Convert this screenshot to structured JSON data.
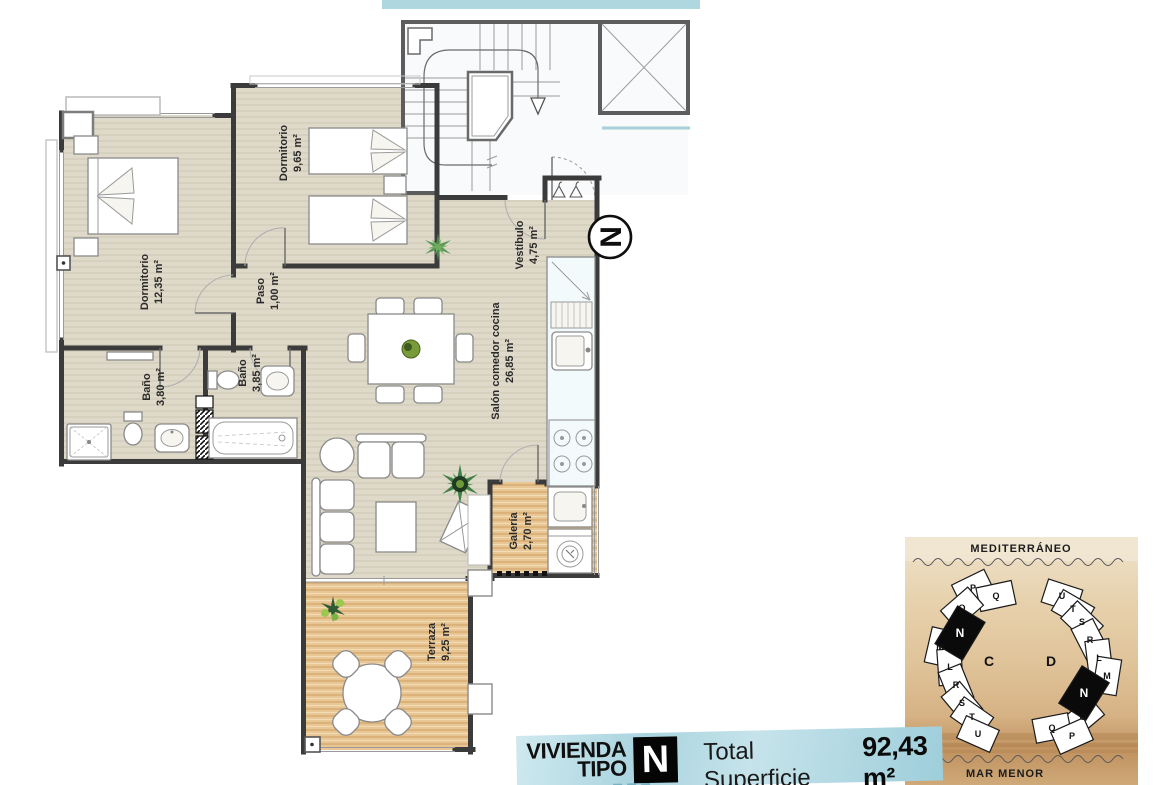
{
  "rooms": {
    "dormitorio1": {
      "name": "Dormitorio",
      "area": "12,35 m²"
    },
    "dormitorio2": {
      "name": "Dormitorio",
      "area": "9,65 m²"
    },
    "paso": {
      "name": "Paso",
      "area": "1,00 m²"
    },
    "bano1": {
      "name": "Baño",
      "area": "3,80 m²"
    },
    "bano2": {
      "name": "Baño",
      "area": "3,85 m²"
    },
    "salon": {
      "name": "Salón comedor cocina",
      "area": "26,85 m²"
    },
    "vestibulo": {
      "name": "Vestíbulo",
      "area": "4,75 m²"
    },
    "galeria": {
      "name": "Galería",
      "area": "2,70 m²"
    },
    "terraza": {
      "name": "Terraza",
      "area": "9,25 m²"
    }
  },
  "compass": {
    "letter": "N"
  },
  "title_block": {
    "line1": "VIVIENDA",
    "line2": "TIPO",
    "type_letter": "N",
    "total_label": "Total Superficie",
    "total_value": "92,43 m²",
    "footnote": "* Incluyendo zonas comunes, terrazas y galería al 100%"
  },
  "site_map": {
    "top_label": "MEDITERRÁNEO",
    "bottom_label": "MAR MENOR",
    "buildings": [
      {
        "name": "C",
        "units": [
          "P",
          "Q",
          "O",
          "N",
          "M",
          "L",
          "R",
          "S",
          "T",
          "U"
        ],
        "highlight": "N"
      },
      {
        "name": "D",
        "units": [
          "U",
          "T",
          "S",
          "R",
          "L",
          "M",
          "N",
          "O",
          "Q",
          "P"
        ],
        "highlight": "N"
      }
    ]
  },
  "colors": {
    "wall": "#3b3b3b",
    "floor": "#ded9c8",
    "wood": "#e8c693",
    "accent_blue": "#aed7e0",
    "sand": "#e0c49a",
    "highlight_black": "#0a0a0a"
  }
}
